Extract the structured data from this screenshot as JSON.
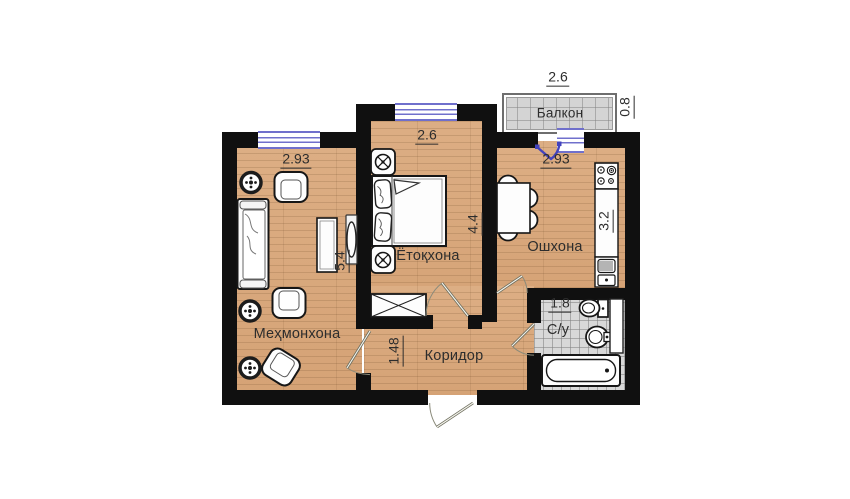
{
  "plan": {
    "type": "apartment-floor-plan",
    "rooms": {
      "living": {
        "label": "Меҳмонхона",
        "width": "2.93",
        "height": "5.4"
      },
      "bedroom": {
        "label": "Ётоқхона",
        "width": "2.6",
        "height": "4.4"
      },
      "kitchen": {
        "label": "Ошхона",
        "width": "2.93",
        "height": "3.2"
      },
      "corridor": {
        "label": "Коридор",
        "width": "1.48"
      },
      "bathroom": {
        "label": "С/у",
        "width": "1.8"
      },
      "balcony": {
        "label": "Балкон",
        "width": "2.6",
        "depth": "0.8"
      }
    },
    "colors": {
      "wall": "#101010",
      "wood_floor": "#daa87b",
      "tile_floor": "#d8d8d8",
      "window": "#7070cc",
      "balcony_door": "#4343bd",
      "door_swing": "#6f6f5f"
    },
    "furniture": [
      "sofa",
      "armchairs",
      "side-tables",
      "coffee-table",
      "tv-stand",
      "bed",
      "nightstands",
      "wardrobe",
      "dining-table",
      "chairs",
      "stove",
      "counter",
      "kitchen-sink",
      "toilet",
      "washbasin",
      "bathtub"
    ]
  }
}
